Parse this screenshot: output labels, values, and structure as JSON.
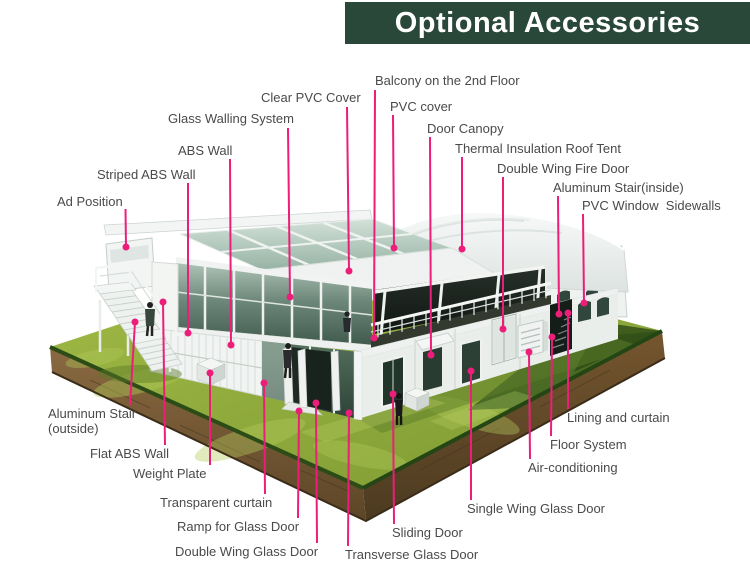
{
  "header": {
    "title": "Optional Accessories",
    "bg_color": "#2a4839",
    "text_color": "#ffffff"
  },
  "colors": {
    "callout_line": "#ec1e79",
    "label_text": "#4a4a4c",
    "grass": "#8fae3b",
    "soil": "#7a5a33",
    "glass": "#3f584c",
    "frame_white": "#f2f5f3"
  },
  "callouts": [
    {
      "id": "ad-position",
      "text": "Ad Position"
    },
    {
      "id": "striped-abs-wall",
      "text": "Striped ABS Wall"
    },
    {
      "id": "abs-wall",
      "text": "ABS Wall"
    },
    {
      "id": "glass-walling-system",
      "text": "Glass Walling System"
    },
    {
      "id": "clear-pvc-cover",
      "text": "Clear PVC Cover"
    },
    {
      "id": "balcony-2nd-floor",
      "text": "Balcony on the 2nd Floor"
    },
    {
      "id": "pvc-cover",
      "text": "PVC cover"
    },
    {
      "id": "door-canopy",
      "text": "Door Canopy"
    },
    {
      "id": "thermal-insulation-roof-tent",
      "text": "Thermal Insulation Roof Tent"
    },
    {
      "id": "double-wing-fire-door",
      "text": "Double Wing Fire Door"
    },
    {
      "id": "aluminum-stair-inside",
      "text": "Aluminum Stair(inside)"
    },
    {
      "id": "pvc-window-sidewalls",
      "text": "PVC Window  Sidewalls"
    },
    {
      "id": "aluminum-stair-outside",
      "text": "Aluminum Stair\n(outside)"
    },
    {
      "id": "flat-abs-wall",
      "text": "Flat ABS Wall"
    },
    {
      "id": "weight-plate",
      "text": "Weight Plate"
    },
    {
      "id": "transparent-curtain",
      "text": "Transparent curtain"
    },
    {
      "id": "ramp-for-glass-door",
      "text": "Ramp for Glass Door"
    },
    {
      "id": "double-wing-glass-door",
      "text": "Double Wing Glass Door"
    },
    {
      "id": "transverse-glass-door",
      "text": "Transverse Glass Door"
    },
    {
      "id": "sliding-door",
      "text": "Sliding Door"
    },
    {
      "id": "single-wing-glass-door",
      "text": "Single Wing Glass Door"
    },
    {
      "id": "air-conditioning",
      "text": "Air-conditioning"
    },
    {
      "id": "floor-system",
      "text": "Floor System"
    },
    {
      "id": "lining-and-curtain",
      "text": "Lining and curtain"
    }
  ]
}
